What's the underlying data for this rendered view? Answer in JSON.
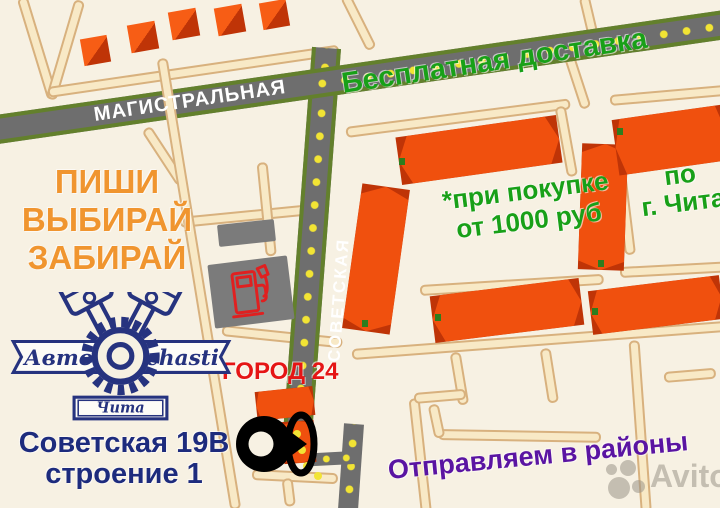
{
  "map": {
    "streets": [
      {
        "name": "МАГИСТРАЛЬНАЯ"
      },
      {
        "name": "СОВЕТСКАЯ"
      }
    ],
    "poi": {
      "store_label": "ГОРОД 24"
    },
    "icons": [
      "fuel-pump-icon",
      "location-pin-icon"
    ]
  },
  "promo": {
    "free_delivery": "Бесплатная доставка",
    "condition_line1": "*при покупке",
    "condition_line2": "от 1000 руб",
    "area_line1": "по",
    "area_line2": "г. Чита",
    "slogan": [
      "ПИШИ",
      "ВЫБИРАЙ",
      "ЗАБИРАЙ"
    ],
    "shipping": "Отправляем в районы"
  },
  "address": {
    "line1": "Советская 19В",
    "line2": "строение 1"
  },
  "logo": {
    "left": "Авто",
    "right": "chasti",
    "city": "Чита"
  },
  "watermark": {
    "text": "Avito"
  },
  "colors": {
    "background": "#f7f1e3",
    "road_gray": "#6e6e6e",
    "road_border_green": "#63802c",
    "road_dot_yellow": "#f2e434",
    "path_beige": "#f8e9c6",
    "building_orange": "#f0500e",
    "building_dark": "#bf3407",
    "text_green": "#18a018",
    "text_orange": "#f0952f",
    "text_red": "#e51515",
    "text_navy": "#1d2b7d",
    "text_purple": "#5a14a2",
    "logo_navy": "#26337f",
    "pump_red": "#e02020"
  }
}
